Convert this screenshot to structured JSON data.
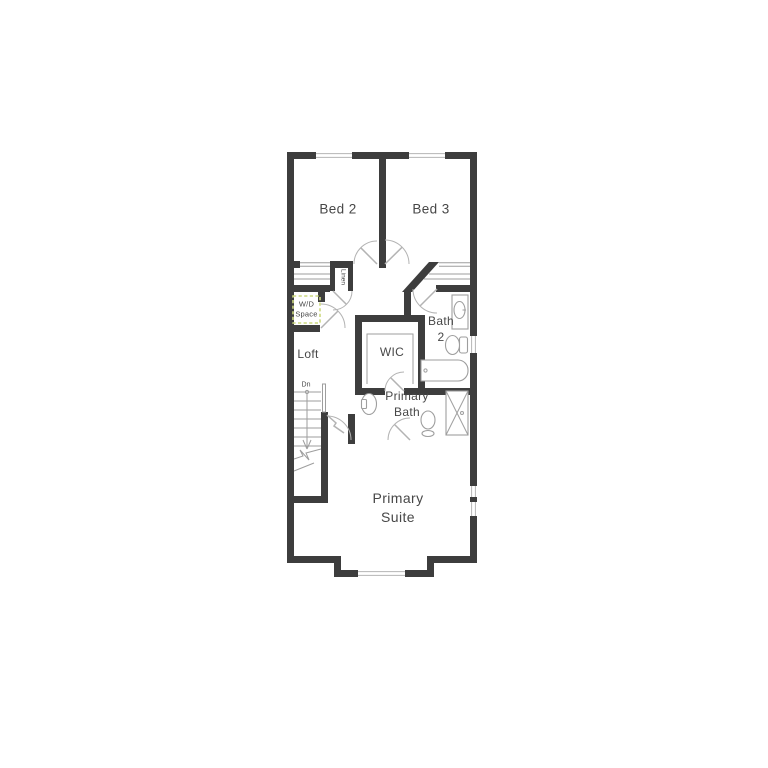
{
  "colors": {
    "bg": "#ffffff",
    "wall": "#3d3d3d",
    "line": "#9e9e9e",
    "arc": "#b3b3b3",
    "text": "#474747",
    "wd_dash": "#ccd87f"
  },
  "rooms": {
    "bed2": {
      "label": "Bed 2"
    },
    "bed3": {
      "label": "Bed 3"
    },
    "linen": {
      "label": "Linen"
    },
    "wd_space": {
      "line1": "W/D",
      "line2": "Space"
    },
    "bath2": {
      "line1": "Bath",
      "line2": "2"
    },
    "loft": {
      "label": "Loft"
    },
    "wic": {
      "label": "WIC"
    },
    "stairs": {
      "label": "Dn"
    },
    "primary_bath": {
      "line1": "Primary",
      "line2": "Bath"
    },
    "primary_suite": {
      "line1": "Primary",
      "line2": "Suite"
    }
  },
  "fixtures": [
    "stairs-down-arrow",
    "washer-dryer-space",
    "vanity-sink",
    "toilet",
    "bathtub",
    "pedestal-sink",
    "shower",
    "closet-shelves",
    "door-swing"
  ]
}
